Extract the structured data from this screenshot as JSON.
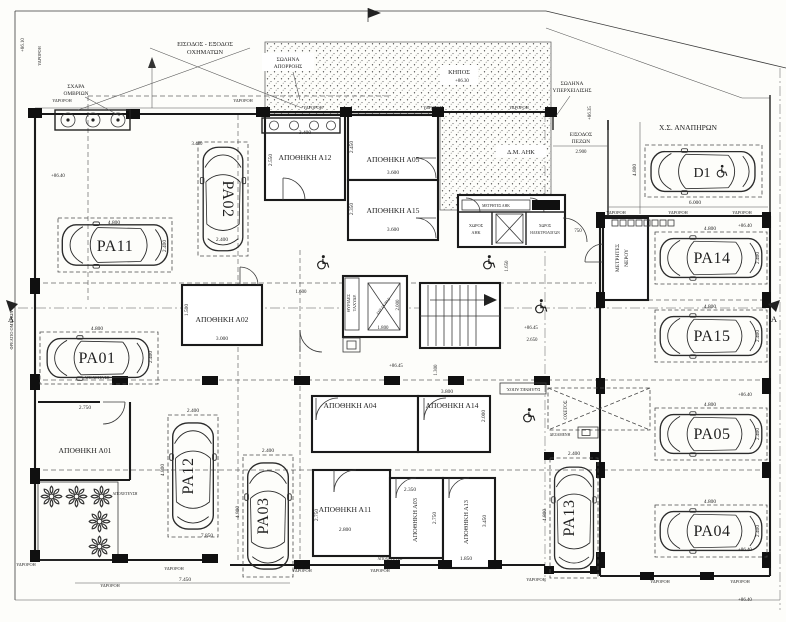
{
  "labels": {
    "downspout": "ΥΔΡΟΡΟΗ",
    "sewer": "ΑΠΟΧΕΤΕΥΣΗ"
  },
  "annotations": {
    "vehicle_entry1": "ΕΙΣΟΔΟΣ - ΕΞΟΔΟΣ",
    "vehicle_entry2": "ΟΧΗΜΑΤΩΝ",
    "grate1": "ΣΧΑΡΑ",
    "grate2": "ΟΜΒΡΙΩΝ",
    "drain1": "ΣΩΛΗΝΑ",
    "drain2": "ΑΠΟΡΡΟΗΣ",
    "garden": "ΚΗΠΟΣ",
    "garden_level": "+86.30",
    "overflow1": "ΣΩΛΗΝΑ",
    "overflow2": "ΥΠΕΡΧΕΙΛΙΣΗΣ",
    "ped1": "ΕΙΣΟΔΟΣ",
    "ped2": "ΠΕΖΩΝ",
    "disabled_space": "Χ.Σ. ΑΝΑΠΗΡΩΝ",
    "dm_ahk": "Δ.Μ. ΑΗΚ",
    "meters_ahk": "ΜΕΤΡΗΤΕΣ ΑΗΚ",
    "room_ahk1": "ΧΩΡΟΣ",
    "room_ahk2": "ΑΗΚ",
    "room_el1": "ΧΩΡΟΣ",
    "room_el2": "ΗΛΕΚΤΡΟΛΟΓΩΝ",
    "water1": "ΜΕΤΡΗΤΕΣ",
    "water2": "ΝΕΡΟΥ",
    "mail1": "ΘΥΡΙΔΕΣ",
    "mail2": "ΤΑΧΥΔΡ.",
    "elevator": "ΑΝΕΛΚ/ΡΑΣ",
    "duct": "ΟΧΕΤΟΣ",
    "tank": "ΔΕΞΑΜΕΝΗ",
    "pipes": "ΣΩΛΗΝΕΣ ΑΠΟΧ.",
    "manhole": "ΦΡΕΑΤΙΟ ΟΜΒΡΙΩΝ",
    "section": "A"
  },
  "levels": {
    "a": "+86.40",
    "b": "+86.45",
    "c": "+86.10",
    "d": "+86.35"
  },
  "dims": {
    "d6000": "6.000",
    "d4800": "4.800",
    "d2900": "2.900",
    "d750": "750",
    "d1650": "1.650",
    "d1600": "1.600",
    "d1800": "1.800",
    "d2000": "2.000",
    "d2650": "2.650",
    "d1300": "1.300",
    "d3480": "3.480",
    "d7850": "7.850",
    "d7450": "7.450"
  },
  "parking": [
    {
      "id": "PA01",
      "len": "4.800",
      "wid": "2.400"
    },
    {
      "id": "PA02",
      "wid": "2.400"
    },
    {
      "id": "PA03",
      "len": "4.800",
      "wid": "2.400"
    },
    {
      "id": "PA04",
      "len": "4.800",
      "wid": "2.400"
    },
    {
      "id": "PA05",
      "len": "4.800",
      "wid": "2.400"
    },
    {
      "id": "PA11",
      "len": "4.800",
      "wid": "2.400"
    },
    {
      "id": "PA12",
      "len": "4.800",
      "wid": "2.400"
    },
    {
      "id": "PA13",
      "len": "4.800",
      "wid": "2.400"
    },
    {
      "id": "PA14",
      "len": "4.800",
      "wid": "2.400"
    },
    {
      "id": "PA15",
      "len": "4.800",
      "wid": "2.400"
    },
    {
      "id": "D1"
    }
  ],
  "storage": [
    {
      "name": "ΑΠΟΘΗΚΗ Α01",
      "d1": "2.750"
    },
    {
      "name": "ΑΠΟΘΗΚΗ Α02",
      "d1": "3.000",
      "d2": "1.500"
    },
    {
      "name": "ΑΠΟΘΗΚΗ Α03",
      "d1": "2.350",
      "d2": "2.750"
    },
    {
      "name": "ΑΠΟΘΗΚΗ Α04"
    },
    {
      "name": "ΑΠΟΘΗΚΗ Α05",
      "d1": "3.600",
      "d2": "2.450"
    },
    {
      "name": "ΑΠΟΘΗΚΗ Α11",
      "d1": "2.800",
      "d2": "2.750"
    },
    {
      "name": "ΑΠΟΘΗΚΗ Α12",
      "d1": "3.400",
      "d2": "2.550"
    },
    {
      "name": "ΑΠΟΘΗΚΗ Α13",
      "d1": "3.450",
      "d2": "1.850"
    },
    {
      "name": "ΑΠΟΘΗΚΗ Α14",
      "d1": "3.800",
      "d2": "2.000"
    },
    {
      "name": "ΑΠΟΘΗΚΗ Α15",
      "d1": "3.600",
      "d2": "2.350"
    }
  ]
}
